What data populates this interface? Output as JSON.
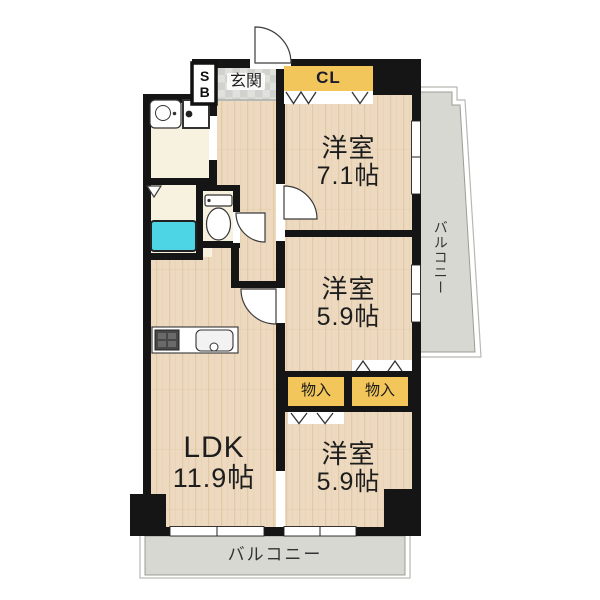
{
  "plan": {
    "type": "apartment-floor-plan",
    "layout_code": "3LDK"
  },
  "rooms": {
    "western1": {
      "name": "洋室",
      "size": "7.1帖"
    },
    "western2": {
      "name": "洋室",
      "size": "5.9帖"
    },
    "western3": {
      "name": "洋室",
      "size": "5.9帖"
    },
    "ldk": {
      "name": "LDK",
      "size": "11.9帖"
    }
  },
  "storages": {
    "shoe_box": "SB",
    "closet": "CL",
    "storage_left": "物入",
    "storage_right": "物入"
  },
  "areas": {
    "entrance": "玄関",
    "balcony_right": "バルコニー",
    "balcony_bottom": "バルコニー"
  },
  "colors": {
    "wall": "#151515",
    "wood_floor": "#ecd9bf",
    "wood_grain": "#dfc5a0",
    "service_floor": "#f6f2df",
    "entrance_tile": "#e0e0dc",
    "entrance_tile_dark": "#d1d1cd",
    "closet_yellow": "#f2c65a",
    "balcony_gray": "#d8d8d2",
    "bathtub_cyan": "#4ed5e5"
  }
}
